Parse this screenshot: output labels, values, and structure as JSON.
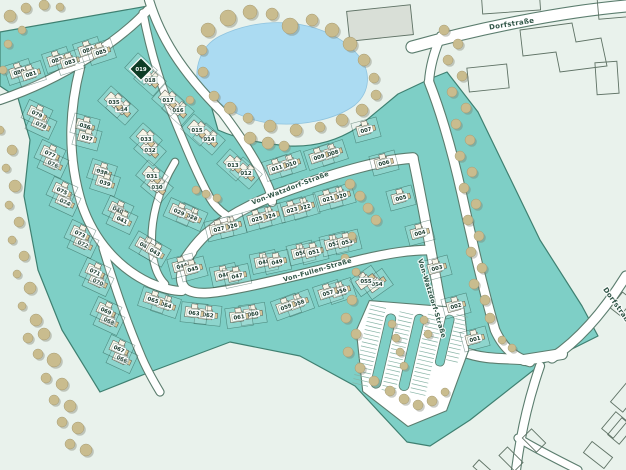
{
  "map": {
    "title": "residential development site plan",
    "highlighted_lot": "019",
    "colors": {
      "background": "#e9f2ec",
      "development": "#7ecfc6",
      "development_edge": "#3f8071",
      "parcel_line": "#1c4a3b",
      "road_fill": "#ffffff",
      "road_casing": "#5b7d6e",
      "pond": "#abdbf2",
      "tree": "#c9bc8e",
      "tree_edge": "#a79c74",
      "tree_shadow": "#7e7f6e",
      "house": "#f7f4e7",
      "house_edge": "#57574b",
      "garage": "#d9c69a",
      "label_bg": "#ffffff",
      "label_text": "#17382b",
      "highlight_fill": "#0e3d26",
      "highlight_text": "#ffffff",
      "street_text": "#2f5546",
      "building_edge": "#5f7265",
      "building_fill": "#d9dfd7",
      "hatch": "#86b3a5"
    },
    "streets": [
      {
        "name": "Von-Watzdorf-Straße",
        "x": 291,
        "y": 190,
        "rot": -21
      },
      {
        "name": "Von-Watzdorf-Straße",
        "x": 430,
        "y": 299,
        "rot": 73
      },
      {
        "name": "Von-Fullen-Straße",
        "x": 318,
        "y": 272,
        "rot": -16
      },
      {
        "name": "Dorfstraße",
        "x": 512,
        "y": 26,
        "rot": -9
      },
      {
        "name": "Dorfstraße",
        "x": 616,
        "y": 308,
        "rot": 55
      }
    ],
    "lots": [
      [
        "001",
        475,
        339,
        -15
      ],
      [
        "002",
        456,
        306,
        -15
      ],
      [
        "003",
        437,
        268,
        -15
      ],
      [
        "004",
        420,
        233,
        -15
      ],
      [
        "005",
        401,
        198,
        -15
      ],
      [
        "006",
        384,
        163,
        -15
      ],
      [
        "007",
        366,
        130,
        -15
      ],
      [
        "008",
        333,
        153,
        -18
      ],
      [
        "009",
        319,
        157,
        -18
      ],
      [
        "010",
        291,
        164,
        -18
      ],
      [
        "011",
        277,
        168,
        -18
      ],
      [
        "012",
        246,
        173,
        42
      ],
      [
        "013",
        233,
        165,
        42
      ],
      [
        "014",
        209,
        139,
        42
      ],
      [
        "015",
        197,
        130,
        42
      ],
      [
        "016",
        178,
        110,
        42
      ],
      [
        "017",
        168,
        100,
        42
      ],
      [
        "018",
        150,
        80,
        42
      ],
      [
        "019",
        141,
        69,
        42
      ],
      [
        "020",
        341,
        196,
        -16
      ],
      [
        "021",
        328,
        199,
        -16
      ],
      [
        "022",
        305,
        207,
        -16
      ],
      [
        "023",
        292,
        210,
        -16
      ],
      [
        "024",
        270,
        216,
        -16
      ],
      [
        "025",
        257,
        219,
        -16
      ],
      [
        "026",
        232,
        226,
        -14
      ],
      [
        "027",
        219,
        229,
        -14
      ],
      [
        "028",
        192,
        217,
        24
      ],
      [
        "029",
        179,
        212,
        24
      ],
      [
        "030",
        157,
        187,
        40
      ],
      [
        "031",
        152,
        176,
        40
      ],
      [
        "032",
        150,
        150,
        42
      ],
      [
        "033",
        146,
        139,
        42
      ],
      [
        "034",
        122,
        109,
        42
      ],
      [
        "035",
        114,
        102,
        42
      ],
      [
        "036",
        85,
        126,
        15
      ],
      [
        "037",
        87,
        138,
        15
      ],
      [
        "038",
        102,
        172,
        18
      ],
      [
        "039",
        105,
        183,
        18
      ],
      [
        "040",
        118,
        210,
        25
      ],
      [
        "041",
        122,
        220,
        25
      ],
      [
        "042",
        145,
        246,
        30
      ],
      [
        "043",
        155,
        252,
        30
      ],
      [
        "044",
        182,
        266,
        -15
      ],
      [
        "045",
        193,
        269,
        -15
      ],
      [
        "046",
        224,
        275,
        -12
      ],
      [
        "047",
        237,
        276,
        -12
      ],
      [
        "048",
        264,
        262,
        -12
      ],
      [
        "049",
        277,
        262,
        -12
      ],
      [
        "050",
        301,
        253,
        -14
      ],
      [
        "051",
        314,
        252,
        -14
      ],
      [
        "052",
        334,
        244,
        -14
      ],
      [
        "053",
        347,
        242,
        -14
      ],
      [
        "054",
        377,
        284,
        -35
      ],
      [
        "055",
        366,
        281,
        -35
      ],
      [
        "056",
        341,
        291,
        -18
      ],
      [
        "057",
        328,
        293,
        -18
      ],
      [
        "058",
        299,
        303,
        -20
      ],
      [
        "059",
        286,
        307,
        -20
      ],
      [
        "060",
        253,
        314,
        -8
      ],
      [
        "061",
        239,
        317,
        -8
      ],
      [
        "062",
        208,
        315,
        6
      ],
      [
        "063",
        194,
        313,
        6
      ],
      [
        "064",
        166,
        305,
        18
      ],
      [
        "065",
        153,
        300,
        18
      ],
      [
        "066",
        122,
        359,
        25
      ],
      [
        "067",
        119,
        349,
        25
      ],
      [
        "068",
        109,
        321,
        25
      ],
      [
        "069",
        106,
        311,
        25
      ],
      [
        "070",
        98,
        282,
        25
      ],
      [
        "071",
        95,
        272,
        25
      ],
      [
        "072",
        83,
        244,
        25
      ],
      [
        "073",
        80,
        234,
        25
      ],
      [
        "074",
        65,
        202,
        25
      ],
      [
        "075",
        62,
        191,
        25
      ],
      [
        "076",
        53,
        164,
        25
      ],
      [
        "077",
        50,
        154,
        25
      ],
      [
        "078",
        41,
        125,
        25
      ],
      [
        "079",
        37,
        114,
        25
      ],
      [
        "080",
        19,
        72,
        -18
      ],
      [
        "081",
        31,
        74,
        -18
      ],
      [
        "082",
        57,
        60,
        -18
      ],
      [
        "083",
        70,
        62,
        -18
      ],
      [
        "084",
        88,
        50,
        -18
      ],
      [
        "085",
        101,
        52,
        -18
      ]
    ]
  }
}
